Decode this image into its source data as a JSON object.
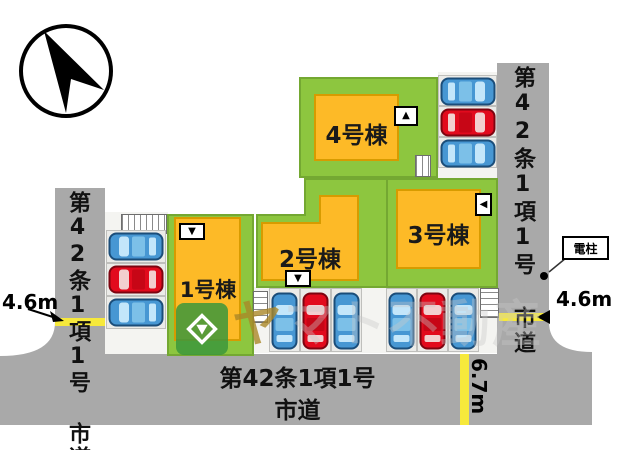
{
  "plan": {
    "type": "site-plan",
    "compass": "north-arrow"
  },
  "roads": {
    "left": {
      "label": "第42条1項1号 市道"
    },
    "right": {
      "label": "第42条1項1号 市道"
    },
    "bottom": {
      "label_line1": "第42条1項1号",
      "label_line2": "市道"
    }
  },
  "dimensions": {
    "left_road_width": "4.6m",
    "right_road_width": "4.6m",
    "bottom_road_width": "6.7m"
  },
  "utility_pole": {
    "label": "電柱"
  },
  "buildings": [
    {
      "id": "1",
      "label": "1号棟",
      "entrance_glyph": "▼"
    },
    {
      "id": "2",
      "label": "2号棟",
      "entrance_glyph": "▼"
    },
    {
      "id": "3",
      "label": "3号棟",
      "entrance_glyph": "◀"
    },
    {
      "id": "4",
      "label": "4号棟",
      "entrance_glyph": "▲"
    }
  ],
  "parking": {
    "left_row": [
      "blue",
      "red",
      "blue"
    ],
    "top_right_row": [
      "blue",
      "red",
      "blue"
    ],
    "bottom_group_1": [
      "blue",
      "red",
      "blue"
    ],
    "bottom_group_2": [
      "blue",
      "red",
      "blue"
    ]
  },
  "colors": {
    "lot_green": "#8dc63f",
    "lot_border": "#74a832",
    "building_yellow": "#fdba27",
    "building_border": "#d79b00",
    "road_gray": "#a9a9a9",
    "stripe_yellow": "#f7e93b",
    "car_blue": "#4797d3",
    "car_red": "#e20a1d"
  },
  "watermark": {
    "first_char": "ヤ",
    "rest_chars": "マト不動産"
  }
}
